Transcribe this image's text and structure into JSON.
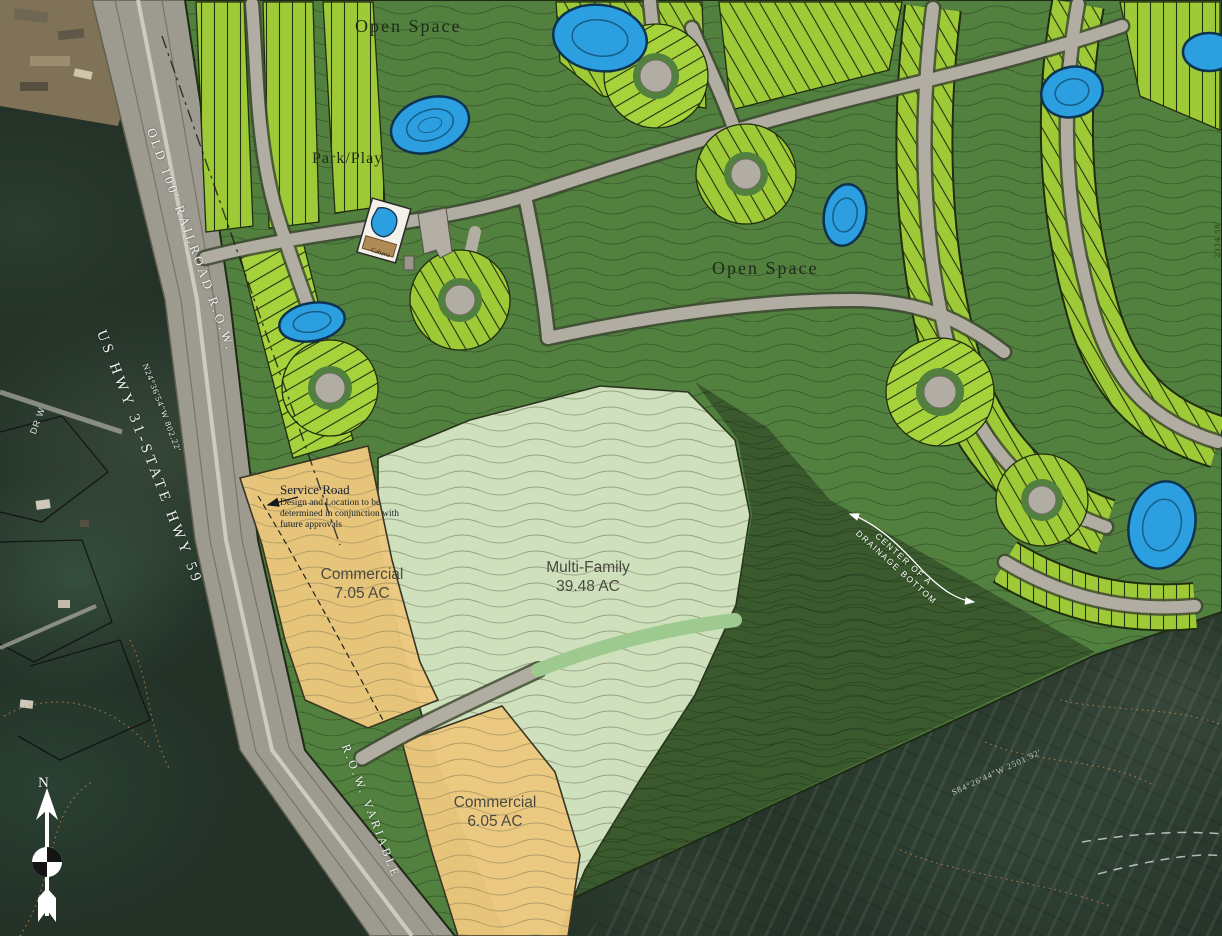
{
  "map": {
    "areas": {
      "open_space_top": {
        "label": "Open Space"
      },
      "park_play": {
        "label": "Park/Play"
      },
      "open_space_mid": {
        "label": "Open Space"
      },
      "commercial_north": {
        "label": "Commercial",
        "acreage": "7.05 AC"
      },
      "multi_family": {
        "label": "Multi-Family",
        "acreage": "39.48 AC"
      },
      "commercial_south": {
        "label": "Commercial",
        "acreage": "6.05 AC"
      }
    },
    "annotations": {
      "service_road": {
        "title": "Service Road",
        "note_line1": "Design and Location to be",
        "note_line2": "determined in conjunction with",
        "note_line3": "future approvals"
      },
      "drainage": {
        "line1": "CENTER OF A",
        "line2": "DRAINAGE BOTTOM"
      },
      "railroad_row": "OLD 100' RAILROAD R.O.W.",
      "highway": "US HWY 31-STATE HWY 59",
      "row_variable": "R.O.W. VARIABLE",
      "bearing_west": "N24°36'54\"W  802.22'",
      "bearing_south": "S84°26'44\"W  2501.92'",
      "bearing_east": "2334.58'",
      "street_name_fragment": "DR W",
      "amenity": "Cabana",
      "compass_north": "N"
    },
    "colors": {
      "open_space_green": "#52803f",
      "lot_green": "#9fca37",
      "pond_blue": "#2b9fe0",
      "commercial_tan": "#ecc87e",
      "multi_family_sage": "#d7e6c6",
      "road_gray": "#b2ada2",
      "aerial_dark": "#243229"
    }
  }
}
